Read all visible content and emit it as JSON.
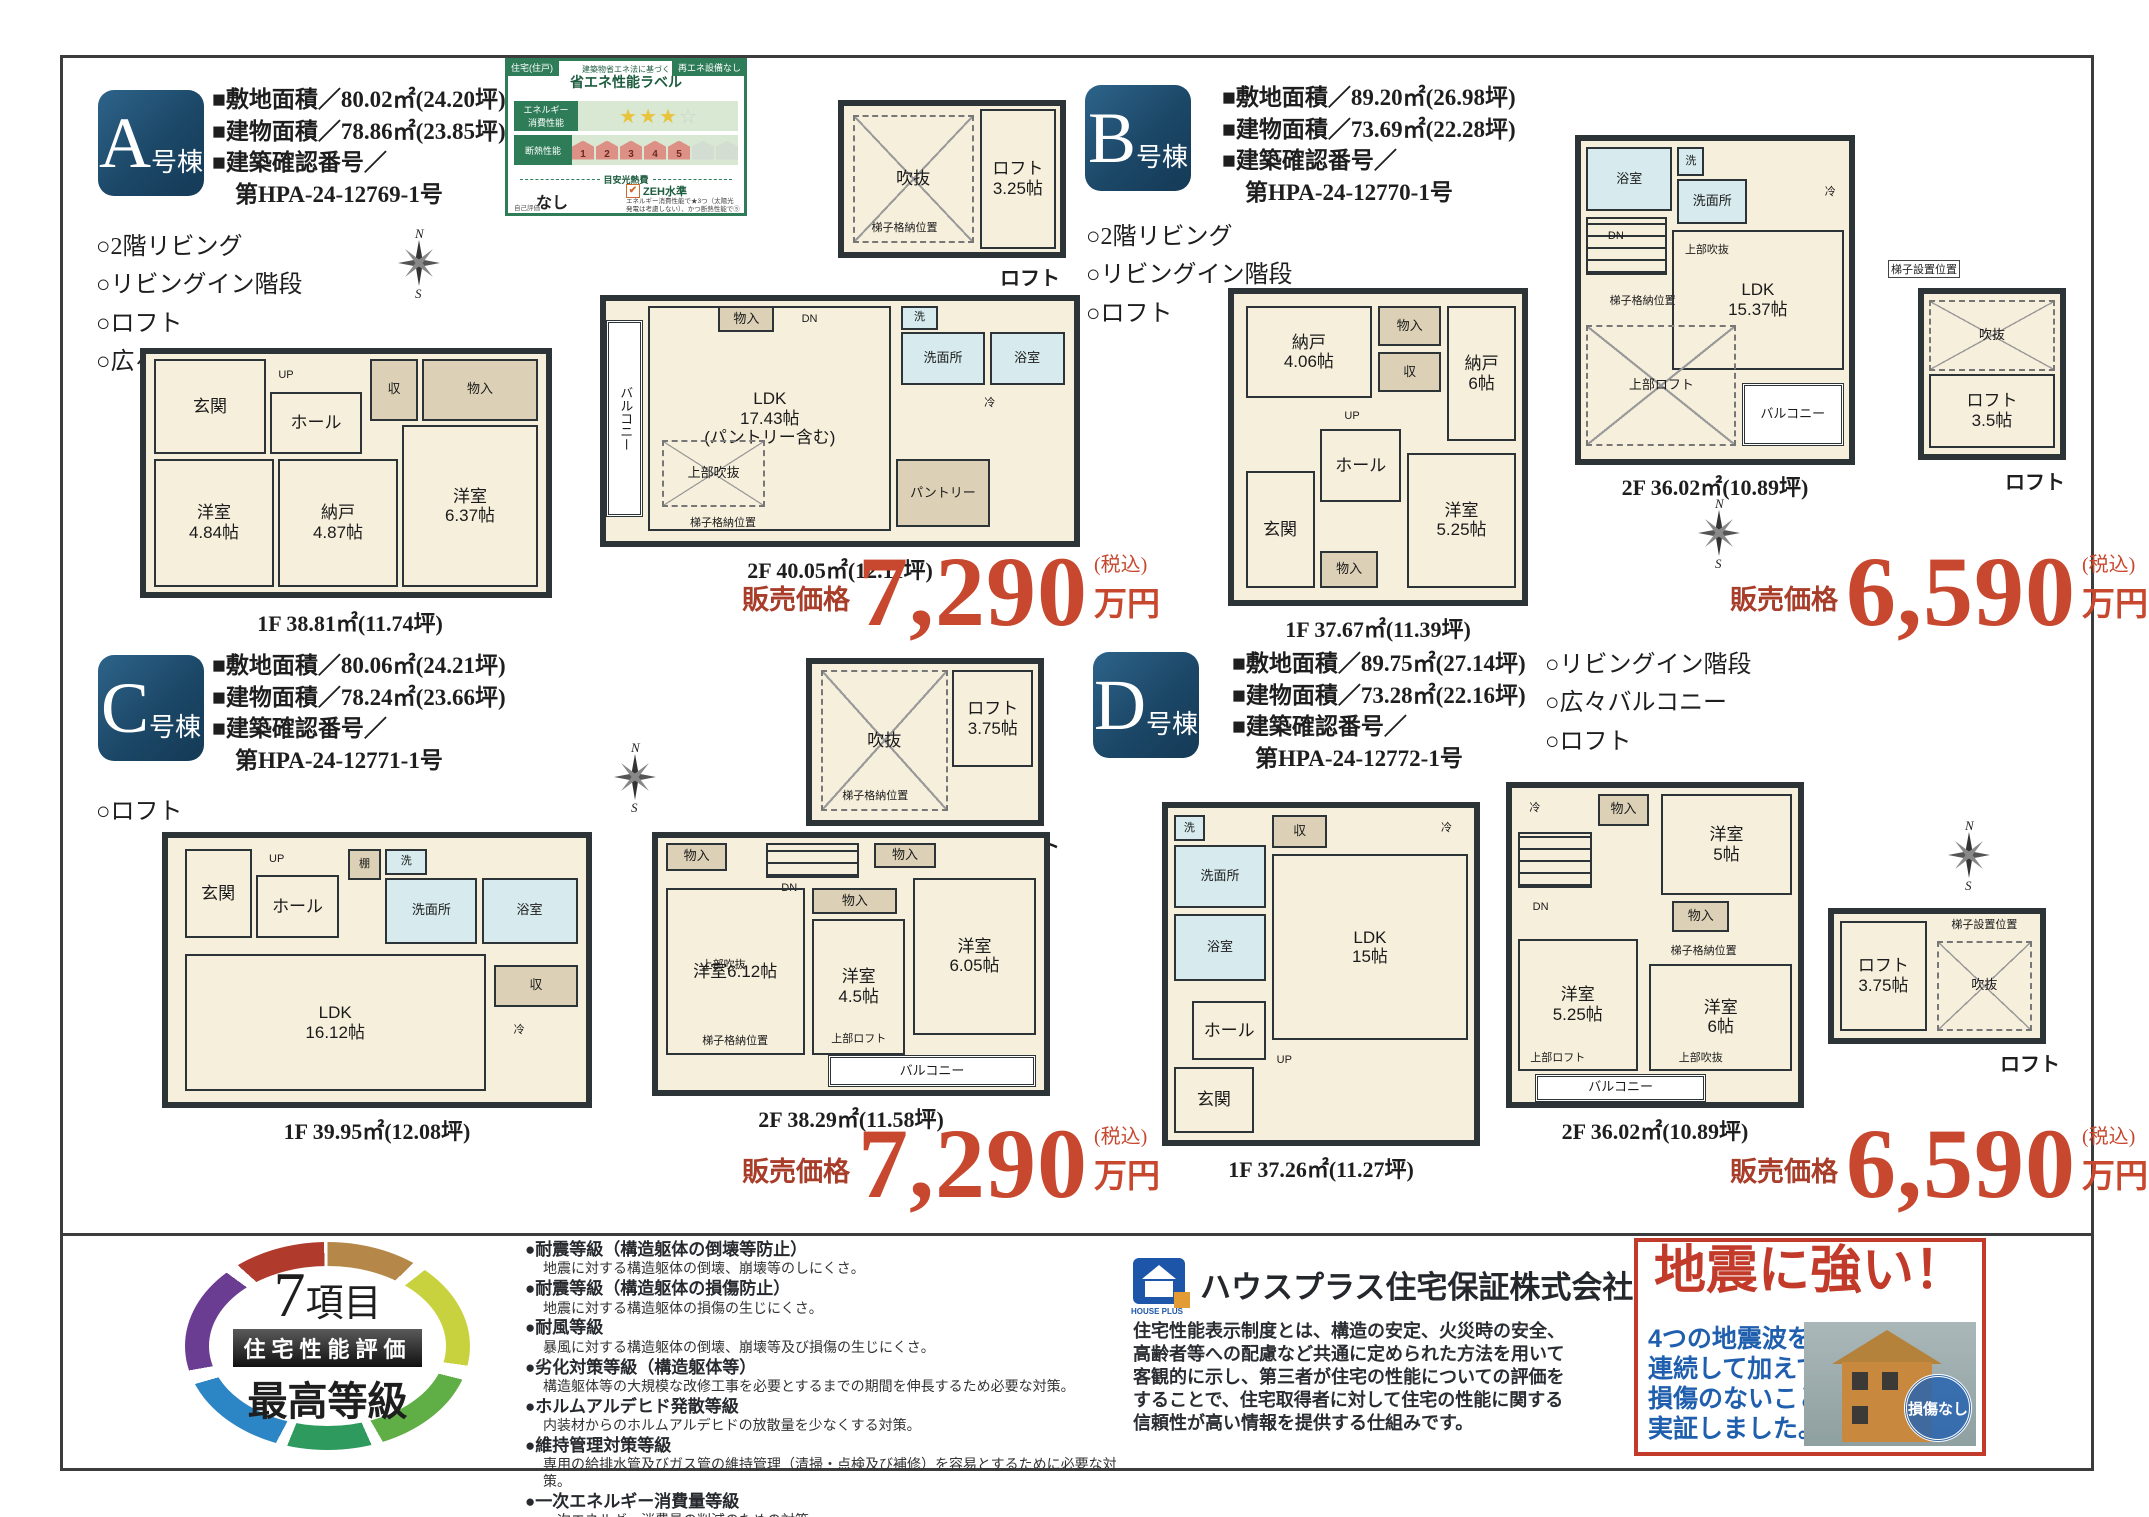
{
  "buildings": [
    {
      "letter": "A",
      "suffix": "号棟",
      "specs": "■敷地面積／80.02㎡(24.20坪)\n■建物面積／78.86㎡(23.85坪)\n■建築確認番号／\n　第HPA-24-12769-1号",
      "features": "○2階リビング\n○リビングイン階段\n○ロフト\n○広々バルコニー",
      "price_label": "販売価格",
      "price": "7,290",
      "price_tax": "(税込)",
      "price_unit": "万円",
      "f1_caption": "1F 38.81㎡(11.74坪)",
      "f1_rooms": [
        "玄関",
        "UP",
        "ホール",
        "収",
        "物入",
        "洋室\n4.84帖",
        "納戸\n4.87帖",
        "洋室\n6.37帖"
      ],
      "f2_caption": "2F 40.05㎡(12.11坪)",
      "f2_rooms": [
        "バルコニー",
        "LDK\n17.43帖\n(パントリー含む)",
        "上部吹抜",
        "梯子格納位置",
        "物入",
        "DN",
        "洗",
        "洗面所",
        "浴室",
        "冷",
        "パントリー"
      ],
      "loft_rooms": [
        "吹抜",
        "梯子格納位置",
        "ロフト\n3.25帖"
      ],
      "loft_caption": "ロフト"
    },
    {
      "letter": "B",
      "suffix": "号棟",
      "specs": "■敷地面積／89.20㎡(26.98坪)\n■建物面積／73.69㎡(22.28坪)\n■建築確認番号／\n　第HPA-24-12770-1号",
      "features": "○2階リビング\n○リビングイン階段\n○ロフト",
      "price_label": "販売価格",
      "price": "6,590",
      "price_tax": "(税込)",
      "price_unit": "万円",
      "f1_caption": "1F 37.67㎡(11.39坪)",
      "f1_rooms": [
        "納戸\n4.06帖",
        "物入",
        "収",
        "納戸\n6帖",
        "UP",
        "ホール",
        "玄関",
        "物入",
        "洋室\n5.25帖"
      ],
      "f2_caption": "2F 36.02㎡(10.89坪)",
      "f2_rooms": [
        "浴室",
        "洗",
        "洗面所",
        "冷",
        "DN",
        "梯子格納位置",
        "LDK\n15.37帖",
        "上部吹抜",
        "上部ロフト",
        "バルコニー"
      ],
      "loft_tag": "梯子設置位置",
      "loft_rooms": [
        "吹抜",
        "ロフト\n3.5帖"
      ],
      "loft_caption": "ロフト"
    },
    {
      "letter": "C",
      "suffix": "号棟",
      "specs": "■敷地面積／80.06㎡(24.21坪)\n■建物面積／78.24㎡(23.66坪)\n■建築確認番号／\n　第HPA-24-12771-1号",
      "features": "○ロフト",
      "price_label": "販売価格",
      "price": "7,290",
      "price_tax": "(税込)",
      "price_unit": "万円",
      "f1_caption": "1F 39.95㎡(12.08坪)",
      "f1_rooms": [
        "玄関",
        "UP",
        "ホール",
        "棚",
        "洗",
        "洗面所",
        "浴室",
        "LDK\n16.12帖",
        "収",
        "冷"
      ],
      "f2_caption": "2F 38.29㎡(11.58坪)",
      "f2_rooms": [
        "物入",
        "DN",
        "物入",
        "洋室6.12帖",
        "上部吹抜",
        "梯子格納位置",
        "洋室\n4.5帖",
        "上部ロフト",
        "洋室\n6.05帖",
        "物入",
        "バルコニー"
      ],
      "loft_rooms": [
        "吹抜",
        "梯子格納位置",
        "ロフト\n3.75帖"
      ],
      "loft_caption": "ロフト"
    },
    {
      "letter": "D",
      "suffix": "号棟",
      "specs": "■敷地面積／89.75㎡(27.14坪)\n■建物面積／73.28㎡(22.16坪)\n■建築確認番号／\n　第HPA-24-12772-1号",
      "features": "○リビングイン階段\n○広々バルコニー\n○ロフト",
      "price_label": "販売価格",
      "price": "6,590",
      "price_tax": "(税込)",
      "price_unit": "万円",
      "f1_caption": "1F 37.26㎡(11.27坪)",
      "f1_rooms": [
        "洗",
        "洗面所",
        "浴室",
        "収",
        "冷",
        "LDK\n15帖",
        "ホール",
        "玄関",
        "UP"
      ],
      "f2_caption": "2F 36.02㎡(10.89坪)",
      "f2_rooms": [
        "冷",
        "物入",
        "洋室\n5帖",
        "DN",
        "物入",
        "梯子格納位置",
        "洋室\n6帖",
        "上部吹抜",
        "洋室\n5.25帖",
        "上部ロフト",
        "バルコニー"
      ],
      "loft_rooms": [
        "ロフト\n3.75帖",
        "梯子設置位置",
        "吹抜"
      ],
      "loft_caption": "ロフト"
    }
  ],
  "energy_label": {
    "tab_left": "住宅(住戸)",
    "tab_right": "再エネ設備なし",
    "subtitle": "建築物省エネ法に基づく",
    "title": "省エネ性能ラベル",
    "row1_label": "エネルギー\n消費性能",
    "row2_label": "断熱性能",
    "row2_levels": [
      "1",
      "2",
      "3",
      "4",
      "5"
    ],
    "cost_label": "目安光熱費",
    "cost_value": "なし",
    "zeh": "ZEH水準",
    "zeh_note": "エネルギー消費性能で★3つ（太陽光発電は考慮しない）、かつ断熱性能で⑤",
    "footer": "自己評価"
  },
  "icons": {
    "star_filled": "★",
    "star_empty": "☆",
    "check": "✔"
  },
  "compass": {
    "n": "N",
    "s": "S"
  },
  "footer": {
    "badge": {
      "number": "7",
      "unit": "項目",
      "banner": "住宅性能評価",
      "grade": "最高等級"
    },
    "ratings": [
      {
        "t": "●耐震等級（構造躯体の倒壊等防止）",
        "d": "地震に対する構造躯体の倒壊、崩壊等のしにくさ。"
      },
      {
        "t": "●耐震等級（構造躯体の損傷防止）",
        "d": "地震に対する構造躯体の損傷の生じにくさ。"
      },
      {
        "t": "●耐風等級",
        "d": "暴風に対する構造躯体の倒壊、崩壊等及び損傷の生じにくさ。"
      },
      {
        "t": "●劣化対策等級（構造躯体等）",
        "d": "構造躯体等の大規模な改修工事を必要とするまでの期間を伸長するため必要な対策。"
      },
      {
        "t": "●ホルムアルデヒド発散等級",
        "d": "内装材からのホルムアルデヒドの放散量を少なくする対策。"
      },
      {
        "t": "●維持管理対策等級",
        "d": "専用の給排水管及びガス管の維持管理（清掃・点検及び補修）を容易とするために必要な対策。"
      },
      {
        "t": "●一次エネルギー消費量等級",
        "d": "一次エネルギー消費量の削減のための対策。"
      }
    ],
    "company": {
      "logo_text": "HOUSE PLUS",
      "name": "ハウスプラス住宅保証株式会社",
      "body": "住宅性能表示制度とは、構造の安定、火災時の安全、\n高齢者等への配慮など共通に定められた方法を用いて\n客観的に示し、第三者が住宅の性能についての評価を\nすることで、住宅取得者に対して住宅の性能に関する\n信頼性が高い情報を提供する仕組みです。"
    },
    "quake": {
      "title": "地震に強い！",
      "body": "4つの地震波を\n連続して加えても\n損傷のないことを\n実証しました。",
      "badge": "損傷なし"
    }
  }
}
